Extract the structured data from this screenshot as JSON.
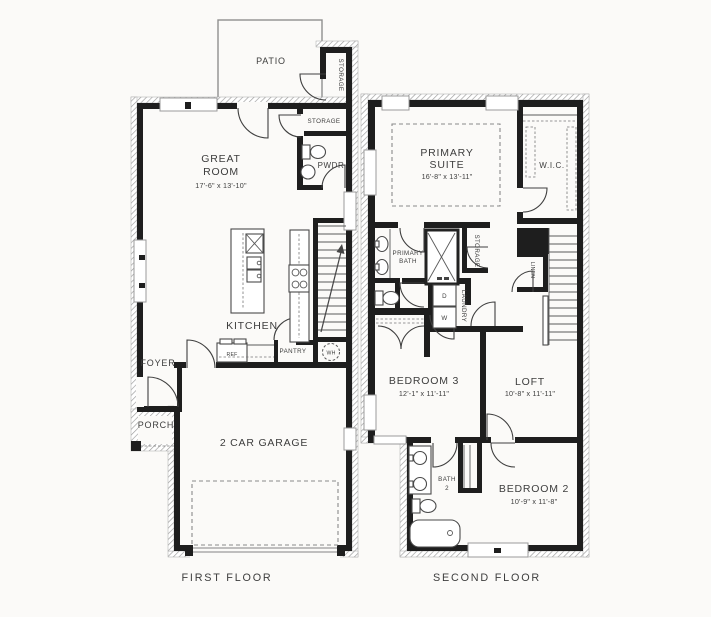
{
  "colors": {
    "wall": "#1e1e1e",
    "window_frame": "#9b9b9b",
    "hatch": "#9a9a9a",
    "text": "#3d3d3d",
    "dashed_line": "#8a8a8a",
    "background": "#fbfaf8"
  },
  "first_floor": {
    "caption": "FIRST FLOOR",
    "patio": "PATIO",
    "patio_storage": "STORAGE",
    "great_room_l1": "GREAT",
    "great_room_l2": "ROOM",
    "great_room_dims": "17'-6\" x 13'-10\"",
    "storage": "STORAGE",
    "powder": "PWDR",
    "kitchen": "KITCHEN",
    "ref": "REF",
    "pantry": "PANTRY",
    "foyer": "FOYER",
    "porch": "PORCH",
    "garage": "2 CAR GARAGE",
    "water_heater": "WH"
  },
  "second_floor": {
    "caption": "SECOND FLOOR",
    "primary_l1": "PRIMARY",
    "primary_l2": "SUITE",
    "primary_dims": "16'-8\" x 13'-11\"",
    "wic": "W.I.C.",
    "primary_bath_l1": "PRIMARY",
    "primary_bath_l2": "BATH",
    "storage": "STORAGE",
    "laundry": "LAUNDRY",
    "linen": "LINEN",
    "dryer": "D",
    "washer": "W",
    "bedroom3": "BEDROOM 3",
    "bedroom3_dims": "12'-1\" x 11'-11\"",
    "loft": "LOFT",
    "loft_dims": "10'-8\" x 11'-11\"",
    "bath2_l1": "BATH",
    "bath2_l2": "2",
    "bedroom2": "BEDROOM 2",
    "bedroom2_dims": "10'-9\" x 11'-8\""
  }
}
